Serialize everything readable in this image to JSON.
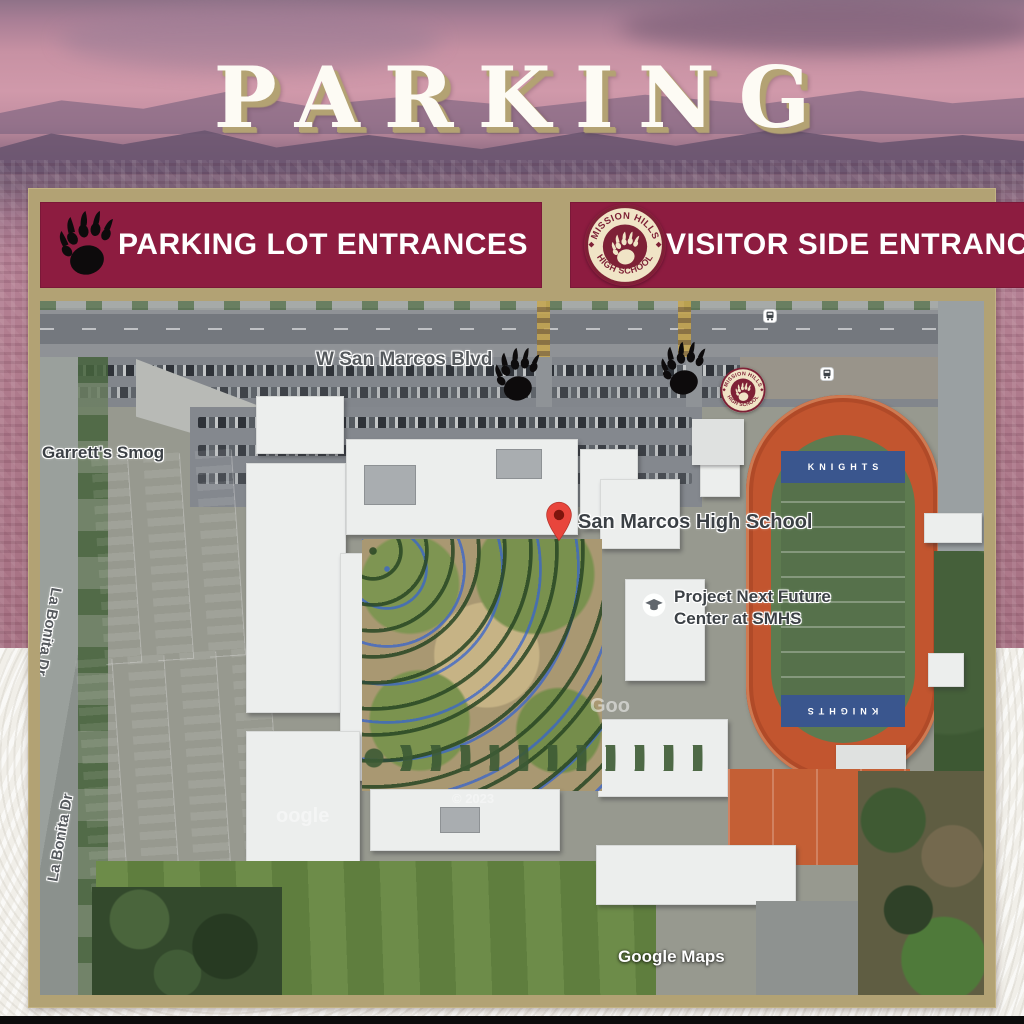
{
  "title": "PARKING",
  "legend": {
    "parking_label": "PARKING LOT ENTRANCES",
    "visitor_label": "VISITOR SIDE ENTRANCE"
  },
  "logo": {
    "arc_top": "MISSION HILLS",
    "arc_bottom": "HIGH SCHOOL"
  },
  "map": {
    "street_blvd": "W San Marcos Blvd",
    "street_la_bonita": "La Bonita Dr",
    "poi_smog": "Garrett's Smog",
    "poi_school": "San Marcos High School",
    "poi_project_line1": "Project Next Future",
    "poi_project_line2": "Center at SMHS",
    "endzone_text": "KNIGHTS",
    "attribution": "Google Maps",
    "watermark_fragment_1": "Goo",
    "watermark_fragment_2": "oogle",
    "copyright": "© 2023"
  },
  "icons": {
    "bear_paw": "black bear paw print — parking lot entrance marker",
    "school_logo": "Mission Hills High School circular crest with paw",
    "map_pin": "red location pin",
    "bus_stop": "white transit-stop square with bus glyph",
    "education_poi": "white circle with graduation-cap glyph"
  },
  "colors": {
    "maroon": "#8d1c40",
    "gold_frame": "#b2a274",
    "title_white": "#fdfbf4",
    "track_red": "#c2552f",
    "endzone_blue": "#3a568e",
    "pin_red": "#e8453c"
  }
}
